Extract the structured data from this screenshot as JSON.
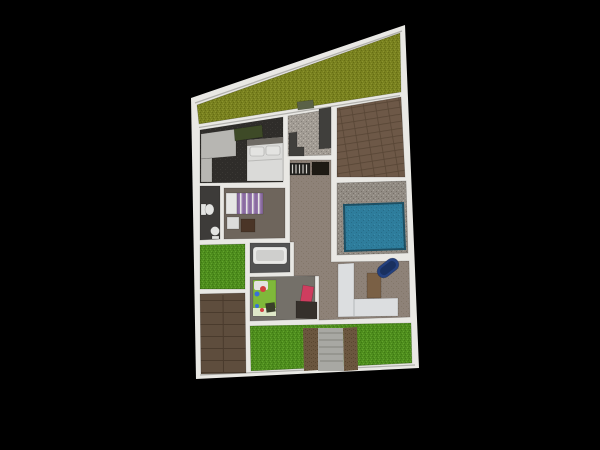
{
  "scene": {
    "background": "#000000",
    "view": "floor-plan-3d-top-view"
  },
  "areas": [
    {
      "name": "side-yard-triangle-grass"
    },
    {
      "name": "master-bedroom"
    },
    {
      "name": "kitchen"
    },
    {
      "name": "wood-floor-room"
    },
    {
      "name": "hallway-living-patio"
    },
    {
      "name": "bathroom"
    },
    {
      "name": "purple-bedroom"
    },
    {
      "name": "left-grass-patch"
    },
    {
      "name": "bathtub-room"
    },
    {
      "name": "kids-playroom"
    },
    {
      "name": "wood-driveway"
    },
    {
      "name": "pool-deck"
    },
    {
      "name": "front-yard"
    }
  ],
  "objects": [
    {
      "name": "wardrobe"
    },
    {
      "name": "green-desk"
    },
    {
      "name": "double-bed"
    },
    {
      "name": "toilet"
    },
    {
      "name": "pedestal-sink"
    },
    {
      "name": "purple-striped-bed"
    },
    {
      "name": "nightstand"
    },
    {
      "name": "ottoman"
    },
    {
      "name": "bathtub"
    },
    {
      "name": "play-mat"
    },
    {
      "name": "pink-chair"
    },
    {
      "name": "dark-desk"
    },
    {
      "name": "toys"
    },
    {
      "name": "staircase"
    },
    {
      "name": "dark-cabinet"
    },
    {
      "name": "kitchen-counter"
    },
    {
      "name": "kitchen-island"
    },
    {
      "name": "green-table"
    },
    {
      "name": "swimming-pool"
    },
    {
      "name": "l-shaped-sofa"
    },
    {
      "name": "coffee-table"
    },
    {
      "name": "blue-lounge-chair"
    },
    {
      "name": "concrete-step-path"
    },
    {
      "name": "dirt-strips"
    }
  ],
  "palette": {
    "background": "#000000",
    "wall": "#e9e8e4",
    "wallShade": "#b2b1ad",
    "lotStroke": "#8f8e8a",
    "grassOliveBase": "#79811f",
    "grassOliveDark": "#666e14",
    "grassOliveLight": "#8a932d",
    "grassBase": "#4e8d1d",
    "grassDark": "#3f7a14",
    "grassLight": "#61a22c",
    "matGreen": "#7fb83a",
    "matLight": "#a5d36a",
    "matPale": "#dfe8c8",
    "speckBase": "#a29c94",
    "speckDark": "#86807a",
    "speckLight": "#bab4ac",
    "deckBase": "#918b83",
    "deckDark": "#776f67",
    "deckLight": "#a6a098",
    "woodBase": "#6d5847",
    "woodSeam": "#574535",
    "driveBase": "#5e4d3d",
    "driveSeam": "#4a3b2d",
    "taupeBase": "#8e8278",
    "taupeDark": "#837769",
    "masterFloor": "#2f2d2a",
    "masterNoise": "#3a3834",
    "kitchenCounter": "#403f3c",
    "deskOlive": "#3e4a27",
    "wardrobe": "#b7b6b2",
    "wardrobeEdge": "#999893",
    "bedWhite": "#dadad8",
    "bedShadow": "#b9b9b7",
    "headboard": "#6e6a64",
    "bathFloor": "#3d3b39",
    "fixtureWhite": "#e3e3e1",
    "purpleFloor": "#6e655c",
    "purpleBed": "#9678ad",
    "purpleBedDark": "#7d5f94",
    "pillowWhite": "#e6e6e4",
    "nightstand": "#dcdcda",
    "ottoman": "#4a3527",
    "tubFloor": "#535353",
    "tubWhite": "#e8e8e6",
    "tubInner": "#cfcfcd",
    "kidsFloor": "#747069",
    "toyRed": "#d14040",
    "toyBlue": "#3a6fd8",
    "toyDark": "#3a3f2a",
    "chairPink": "#cf3d5f",
    "deskDark": "#35302b",
    "stairBase": "#23221f",
    "stairTread": "#cfcdc7",
    "cabinetBlack": "#1e1a14",
    "tableGreen": "#5a6147",
    "tableGreenEdge": "#3c4230",
    "poolBase": "#2e7d9c",
    "poolDark": "#276d89",
    "poolLight": "#3a8cab",
    "poolRim": "#1d4f63",
    "sofa": "#dcdee0",
    "sofaEdge": "#b4b8ba",
    "coffeeTable": "#7a6045",
    "coffeeTableEdge": "#5f4a33",
    "lounge": "#24407e",
    "loungeDark": "#19305f",
    "concrete": "#a8a8a3",
    "concreteStep": "#8f8f8a",
    "dirtBase": "#6b563f",
    "dirtDark": "#59462f"
  }
}
